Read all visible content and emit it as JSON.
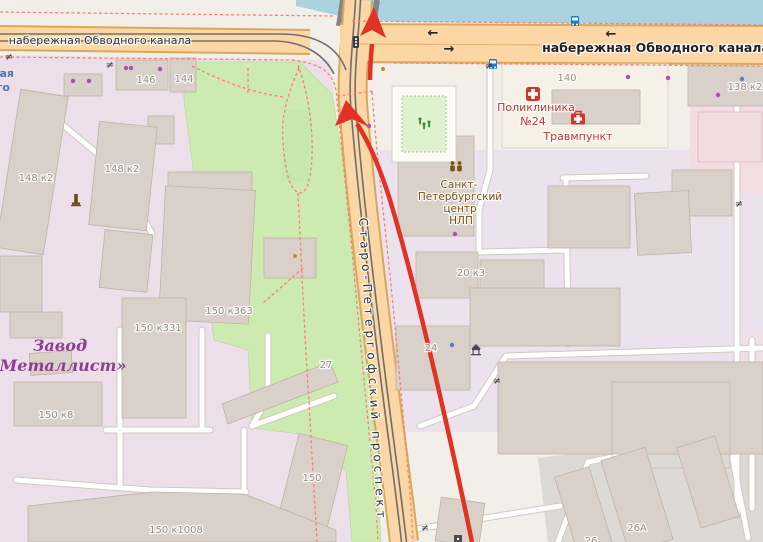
{
  "map": {
    "streets": {
      "embankment_left": "набережная Обводного канала",
      "embankment_right": "набережная Обводного канала",
      "prospekt": "Старо-Петергофский проспект"
    },
    "water_label": {
      "line1": "ая",
      "line2": "го"
    },
    "pois": {
      "polyclinic_line1": "Поликлиника",
      "polyclinic_line2": "№24",
      "trauma": "Травмпункт",
      "nlp_line1": "Санкт-",
      "nlp_line2": "Петербургский",
      "nlp_line3": "центр",
      "nlp_line4": "НЛП",
      "factory_line1": "Завод",
      "factory_line2": "«Металлист»"
    },
    "house_numbers": {
      "n146": "146",
      "n144": "144",
      "n140": "140",
      "n138k2": "138 к2",
      "n148k2_a": "148 к2",
      "n148k2_b": "148 к2",
      "n150k363": "150 к363",
      "n150k331": "150 к331",
      "n150k8": "150 к8",
      "n150k1008": "150 к1008",
      "n150": "150",
      "n27": "27",
      "n24": "24",
      "n20k3": "20 к3",
      "n26a": "26А",
      "n26": "26"
    },
    "symbols": {
      "arrow_left": "←",
      "arrow_right": "→",
      "gate": "≠"
    },
    "colors": {
      "water": "#aad3df",
      "road": "#fcd6a4",
      "road_casing": "#d8a85c",
      "park": "#cdebb0",
      "building": "#d9d0c9",
      "industrial": "#ecdfea",
      "route": "#e13223",
      "footpath": "#fa8072",
      "poi_health": "#bf3632",
      "poi_brown": "#7a5213",
      "factory_label": "#8d3f8f",
      "bus": "#1f7ec0"
    },
    "icons": [
      "bus-stop",
      "traffic-light",
      "clinic-cross",
      "first-aid-kit",
      "monument",
      "community-centre",
      "playground",
      "pavilion",
      "gate"
    ]
  }
}
